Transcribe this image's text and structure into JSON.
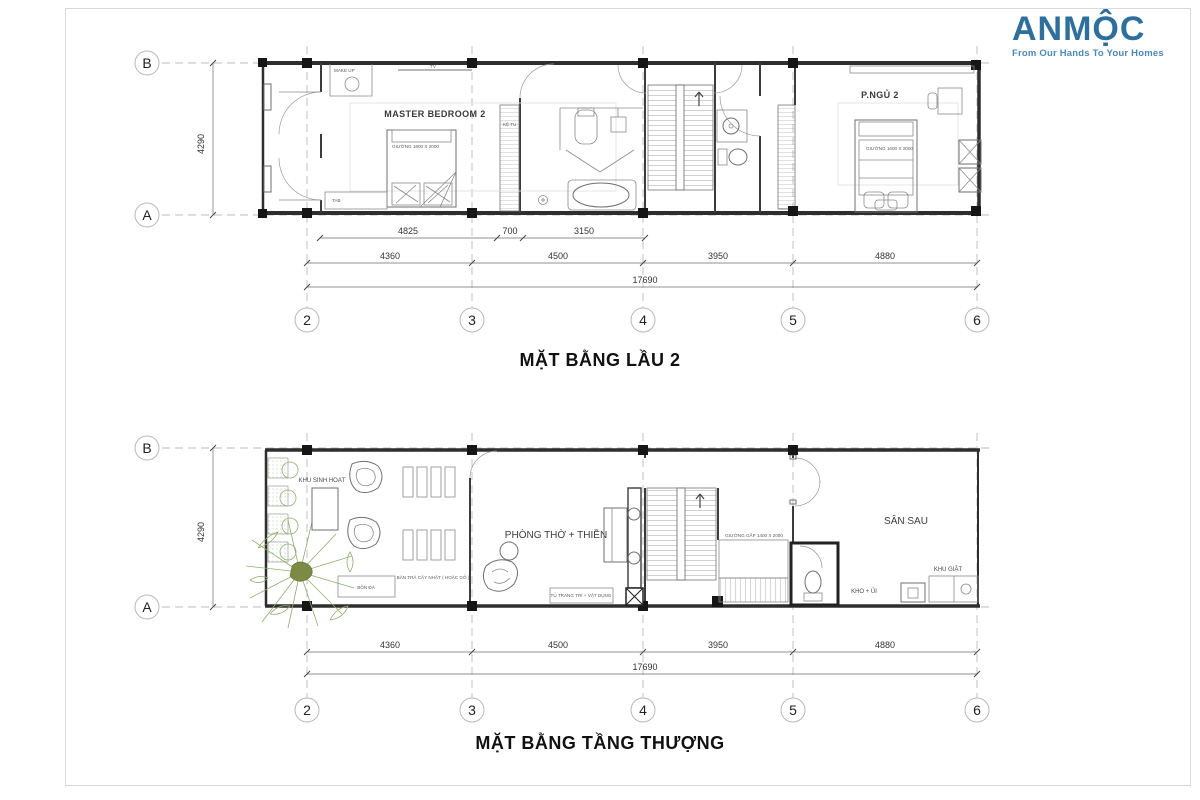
{
  "logo": {
    "name": "ANMỘC",
    "tagline": "From Our Hands To Your Homes",
    "color": "#2e6f9b"
  },
  "plan1": {
    "title": "MẶT BẰNG LẦU 2",
    "row_labels": [
      "B",
      "A"
    ],
    "col_labels": [
      "2",
      "3",
      "4",
      "5",
      "6"
    ],
    "height_dim": "4290",
    "dims_row1": [
      "4825",
      "700",
      "3150"
    ],
    "dims_row2": [
      "4360",
      "4500",
      "3950",
      "4880"
    ],
    "dim_total": "17690",
    "labels": {
      "makeup": "MAKE UP",
      "tv": "TV",
      "master": "MASTER BEDROOM 2",
      "bed_master": "GIƯỜNG 1800 X 2000",
      "tab": "TAB",
      "ketu": "KỆ TỦ",
      "bedroom2": "P.NGỦ 2",
      "bed2": "GIƯỜNG 1600 X 2000"
    }
  },
  "plan2": {
    "title": "MẶT BẰNG TẦNG THƯỢNG",
    "row_labels": [
      "B",
      "A"
    ],
    "col_labels": [
      "2",
      "3",
      "4",
      "5",
      "6"
    ],
    "height_dim": "4290",
    "dims_row2": [
      "4360",
      "4500",
      "3950",
      "4880"
    ],
    "dim_total": "17690",
    "labels": {
      "khu_sinh_hoat": "KHU SINH HOẠT",
      "bon_da": "BỒN ĐÁ",
      "ban_tra": "BÀN TRÀ CÂY NHẬT ( HOẶC GỖ )",
      "phong_tho": "PHÒNG THỜ + THIỀN",
      "tu_trang_tri": "TỦ TRANG TRÍ + VẬT DỤNG",
      "giuong_gap": "GIƯỜNG GẤP 1400 X 2000",
      "san_sau": "SÂN SAU",
      "khu_giat": "KHU GIẶT",
      "kho_ui": "KHO + ỦI"
    }
  }
}
